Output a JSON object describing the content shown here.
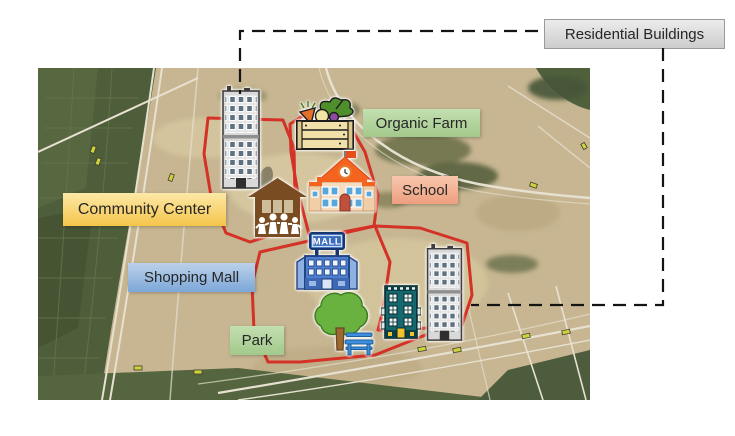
{
  "annotation": {
    "residential_label": "Residential Buildings"
  },
  "map_labels": {
    "organic_farm": "Organic Farm",
    "school": "School",
    "community_center": "Community Center",
    "shopping_mall": "Shopping Mall",
    "park": "Park"
  },
  "map": {
    "mall_sign": "MALL",
    "zone_outline_color": "#d43127",
    "connector_color": "#141414",
    "icons": [
      {
        "name": "residential-tower-icon",
        "zone": "Residential Buildings"
      },
      {
        "name": "organic-farm-crate-icon",
        "zone": "Organic Farm"
      },
      {
        "name": "school-building-icon",
        "zone": "School"
      },
      {
        "name": "community-center-pavilion-icon",
        "zone": "Community Center"
      },
      {
        "name": "shopping-mall-building-icon",
        "zone": "Shopping Mall"
      },
      {
        "name": "park-tree-bench-icon",
        "zone": "Park"
      },
      {
        "name": "apartment-building-icon",
        "zone": "Residential Buildings"
      },
      {
        "name": "residential-tower-2-icon",
        "zone": "Residential Buildings"
      }
    ]
  },
  "colors": {
    "residential_label_bg": "#dcdcdc",
    "organic_farm_label_bg": "#aed29a",
    "school_label_bg": "#f2b296",
    "community_center_label_bg": "#f9d67a",
    "shopping_mall_label_bg": "#9cbde3",
    "park_label_bg": "#aed29a"
  }
}
